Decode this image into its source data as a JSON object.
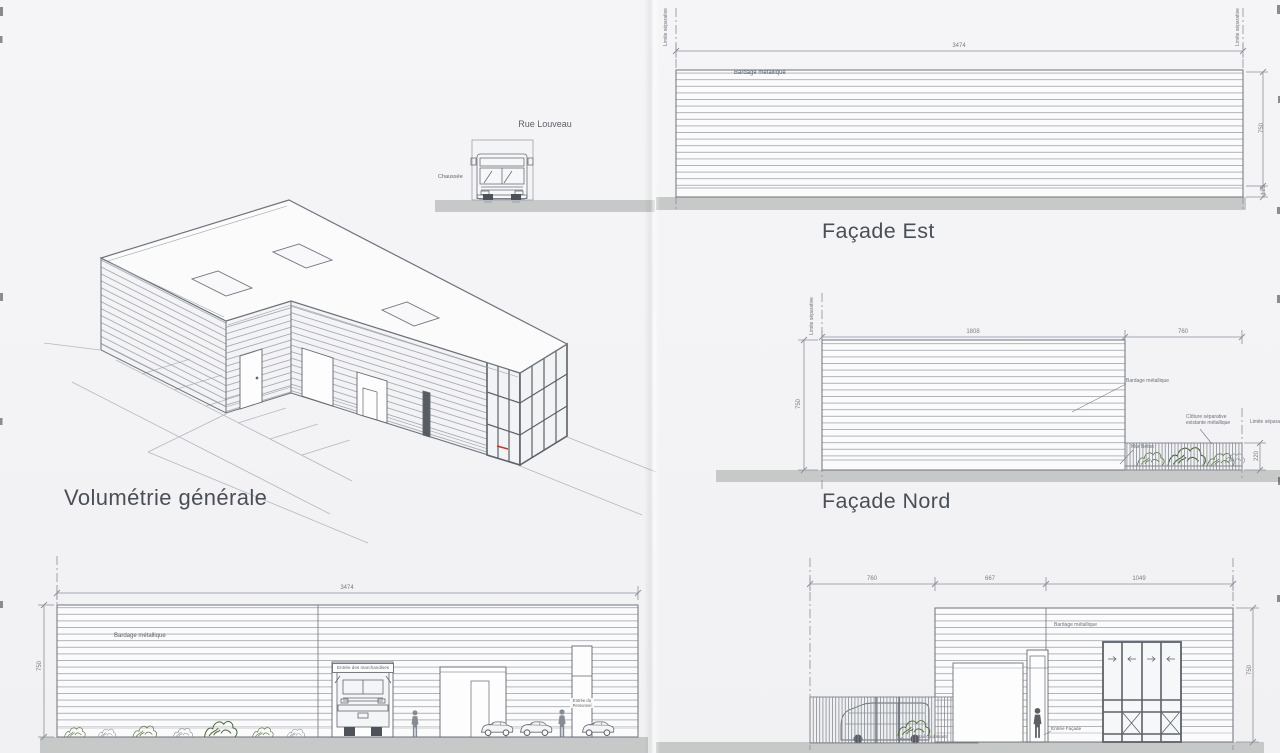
{
  "street_section": {
    "street_label": "Rue Louveau",
    "road_label": "Chaussée"
  },
  "volumetrie": {
    "title": "Volumétrie générale"
  },
  "facade_est": {
    "title": "Façade Est",
    "cladding_label": "Bardage métallique",
    "limit_left": "Limite séparative",
    "limit_right": "Limite séparative",
    "dim_width": "3474",
    "dim_height": "750",
    "dim_base": "125"
  },
  "facade_nord": {
    "title": "Façade Nord",
    "cladding_label": "Bardage métallique",
    "limit_left": "Limite séparative",
    "limit_right_label": "Limite séparative",
    "dim_width": "1808",
    "dim_offset": "760",
    "dim_height": "750",
    "dim_fence": "220",
    "fence_label_1": "Clôture séparative",
    "fence_label_2": "existante métallique",
    "wall_label": "Mur Béton"
  },
  "facade_sud": {
    "cladding_label": "Bardage métallique",
    "dim_width": "3474",
    "dim_height": "750",
    "goods_entrance": "Entrée des marchandises",
    "staff_entrance_1": "Entrée du",
    "staff_entrance_2": "Personnel"
  },
  "facade_ouest": {
    "cladding_label": "Bardage métallique",
    "dim_a": "760",
    "dim_b": "667",
    "dim_c": "1049",
    "dim_height": "750",
    "gate_label": "Portail coulissant",
    "entrance_label": "Entrée Façade"
  },
  "colors": {
    "paper": "#f4f4f5",
    "line": "#6d727b",
    "siding": "#a4a9b1",
    "ground": "#c7c9c8",
    "vegetation": "#5a7245",
    "accent_red": "#c0392b"
  }
}
